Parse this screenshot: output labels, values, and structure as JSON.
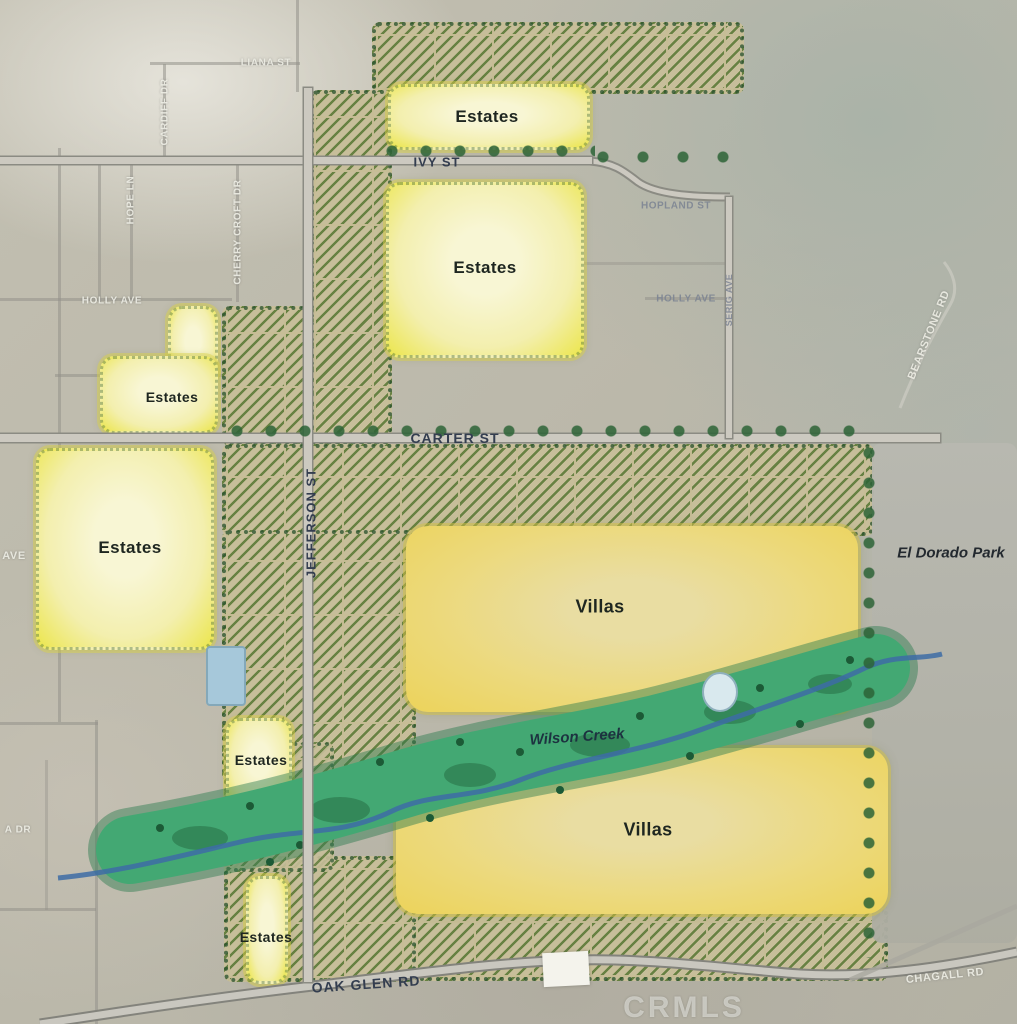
{
  "map": {
    "watermark": "CRMLS",
    "zones": {
      "estates_label": "Estates",
      "villas_label": "Villas"
    },
    "streets": {
      "ivy": "IVY ST",
      "carter": "CARTER ST",
      "jefferson": "JEFFERSON ST",
      "oak_glen": "OAK GLEN RD",
      "liana": "LIANA ST",
      "cardiff": "CARDIFF DR",
      "hope": "HOPE LN",
      "cherry_croft": "CHERRY CROFT DR",
      "holly_west": "HOLLY AVE",
      "holly_east": "HOLLY AVE",
      "hopland": "HOPLAND ST",
      "serig": "SERIG AVE",
      "bearstone": "BEARSTONE RD",
      "chagall": "CHAGALL RD",
      "ave_fragment": "AVE",
      "a_dr_fragment": "A DR"
    },
    "places": {
      "el_dorado_park": "El Dorado Park",
      "wilson_creek": "Wilson Creek"
    },
    "colors": {
      "estates_fill": "#f3efae",
      "villas_fill": "#ecd35a",
      "orchard_green": "#5c7a38",
      "creek_green": "#3fa470",
      "stream_blue": "#3d6ca6",
      "park_gray": "#b2b2a8",
      "road_gray": "#ccc9c0",
      "label_dark": "#333d4f"
    }
  }
}
